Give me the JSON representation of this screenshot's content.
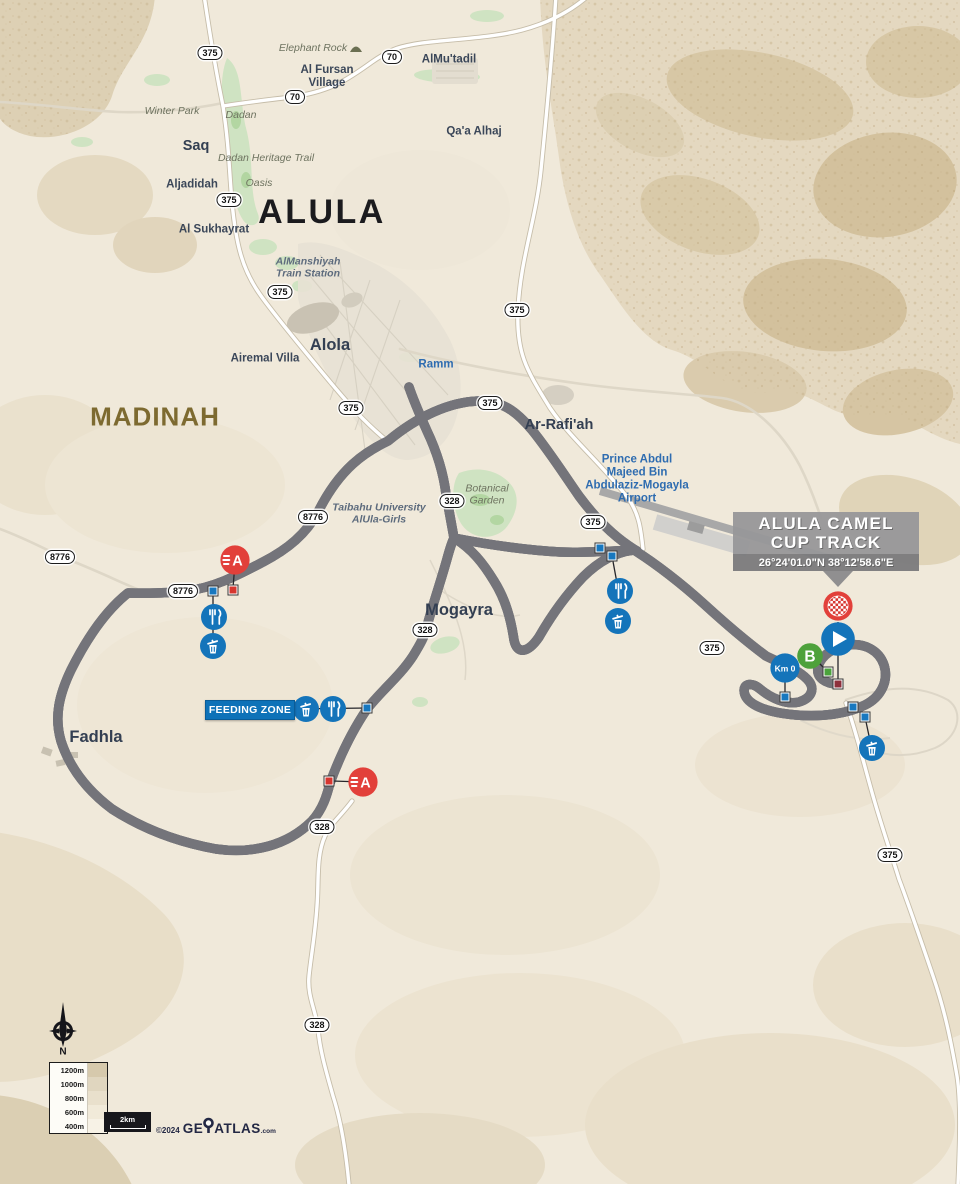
{
  "finish_panel": {
    "line1": "ALULA CAMEL",
    "line2": "CUP TRACK",
    "coordinates": "26°24'01.0\"N 38°12'58.6\"E"
  },
  "feeding_zone": {
    "label": "FEEDING ZONE"
  },
  "legend": {
    "elevations": [
      "1200m",
      "1000m",
      "800m",
      "600m",
      "400m"
    ],
    "swatches": [
      "#d6c9ac",
      "#e0d6bf",
      "#e9e0cc",
      "#f1ead9",
      "#f7f2e6"
    ],
    "scale_label": "2km",
    "copyright": "©2024",
    "brand_prefix": "GE",
    "brand_suffix": "ATLAS",
    "brand_tld": ".com",
    "compass": "N"
  },
  "markers": {
    "sprint_label": "A",
    "bonus_label": "B",
    "km_zero_label": "Km 0"
  },
  "colors": {
    "blue": "#1474ba",
    "red": "#e2403a",
    "green": "#4ea13b",
    "panel_gray": "#97979b"
  },
  "labels": [
    {
      "text": "Elephant Rock",
      "x": 313,
      "y": 49,
      "cls": "it"
    },
    {
      "text": "Al Fursan\nVillage",
      "x": 327,
      "y": 77,
      "cls": "town md"
    },
    {
      "text": "AlMu'tadil",
      "x": 449,
      "y": 60,
      "cls": "town md"
    },
    {
      "text": "Winter Park",
      "x": 172,
      "y": 112,
      "cls": "it"
    },
    {
      "text": "Dadan",
      "x": 241,
      "y": 116,
      "cls": "it"
    },
    {
      "text": "Saq",
      "x": 196,
      "y": 146,
      "cls": "town lg"
    },
    {
      "text": "Qa'a Alhaj",
      "x": 474,
      "y": 132,
      "cls": "town md"
    },
    {
      "text": "Dadan Heritage Trail",
      "x": 266,
      "y": 159,
      "cls": "it"
    },
    {
      "text": "Aljadidah",
      "x": 192,
      "y": 185,
      "cls": "town md"
    },
    {
      "text": "Oasis",
      "x": 259,
      "y": 184,
      "cls": "it"
    },
    {
      "text": "ALULA",
      "x": 322,
      "y": 212,
      "cls": "city"
    },
    {
      "text": "Al Sukhayrat",
      "x": 214,
      "y": 230,
      "cls": "town md"
    },
    {
      "text": "AlManshiyah\nTrain Station",
      "x": 308,
      "y": 268,
      "cls": "itb"
    },
    {
      "text": "Alola",
      "x": 330,
      "y": 345,
      "cls": "town xl"
    },
    {
      "text": "Airemal Villa",
      "x": 265,
      "y": 359,
      "cls": "town md"
    },
    {
      "text": "Ramm",
      "x": 436,
      "y": 365,
      "cls": "blue md"
    },
    {
      "text": "MADINAH",
      "x": 155,
      "y": 417,
      "cls": "region"
    },
    {
      "text": "Ar-Rafi'ah",
      "x": 559,
      "y": 425,
      "cls": "town lg"
    },
    {
      "text": "Prince Abdul\nMajeed Bin\nAbdulaziz-Mogayla\nAirport",
      "x": 637,
      "y": 479,
      "cls": "blue"
    },
    {
      "text": "Taibahu University\nAlUla-Girls",
      "x": 379,
      "y": 514,
      "cls": "itb"
    },
    {
      "text": "Botanical\nGarden",
      "x": 487,
      "y": 495,
      "cls": "it"
    },
    {
      "text": "Mogayra",
      "x": 459,
      "y": 610,
      "cls": "town xl"
    },
    {
      "text": "Fadhla",
      "x": 96,
      "y": 737,
      "cls": "town xl"
    }
  ],
  "shields": [
    {
      "num": "375",
      "x": 210,
      "y": 53
    },
    {
      "num": "70",
      "x": 295,
      "y": 97
    },
    {
      "num": "70",
      "x": 392,
      "y": 57
    },
    {
      "num": "375",
      "x": 229,
      "y": 200
    },
    {
      "num": "375",
      "x": 280,
      "y": 292
    },
    {
      "num": "375",
      "x": 517,
      "y": 310
    },
    {
      "num": "375",
      "x": 351,
      "y": 408
    },
    {
      "num": "375",
      "x": 490,
      "y": 403
    },
    {
      "num": "8776",
      "x": 60,
      "y": 557
    },
    {
      "num": "8776",
      "x": 313,
      "y": 517
    },
    {
      "num": "8776",
      "x": 183,
      "y": 591
    },
    {
      "num": "328",
      "x": 452,
      "y": 501
    },
    {
      "num": "375",
      "x": 593,
      "y": 522
    },
    {
      "num": "328",
      "x": 425,
      "y": 630
    },
    {
      "num": "375",
      "x": 712,
      "y": 648
    },
    {
      "num": "328",
      "x": 322,
      "y": 827
    },
    {
      "num": "375",
      "x": 890,
      "y": 855
    },
    {
      "num": "328",
      "x": 317,
      "y": 1025
    }
  ],
  "icons": [
    {
      "type": "rock",
      "x": 356,
      "y": 48
    },
    {
      "type": "sprint",
      "x": 235,
      "y": 560
    },
    {
      "type": "food",
      "x": 214,
      "y": 617
    },
    {
      "type": "trash",
      "x": 213,
      "y": 646
    },
    {
      "type": "trash",
      "x": 306,
      "y": 709
    },
    {
      "type": "food",
      "x": 333,
      "y": 709
    },
    {
      "type": "sprint",
      "x": 363,
      "y": 782
    },
    {
      "type": "food",
      "x": 620,
      "y": 591
    },
    {
      "type": "trash",
      "x": 618,
      "y": 621
    },
    {
      "type": "km0",
      "x": 785,
      "y": 668
    },
    {
      "type": "bonus",
      "x": 810,
      "y": 656
    },
    {
      "type": "start",
      "x": 838,
      "y": 639
    },
    {
      "type": "finish",
      "x": 838,
      "y": 606
    },
    {
      "type": "trash",
      "x": 872,
      "y": 748
    }
  ],
  "route_squares": [
    {
      "c": "blue",
      "x": 213,
      "y": 591
    },
    {
      "c": "red",
      "x": 233,
      "y": 590
    },
    {
      "c": "blue",
      "x": 367,
      "y": 708
    },
    {
      "c": "red",
      "x": 329,
      "y": 781
    },
    {
      "c": "blue",
      "x": 600,
      "y": 548
    },
    {
      "c": "blue",
      "x": 612,
      "y": 556
    },
    {
      "c": "blue",
      "x": 785,
      "y": 697
    },
    {
      "c": "green",
      "x": 828,
      "y": 672
    },
    {
      "c": "dark",
      "x": 838,
      "y": 684
    },
    {
      "c": "blue",
      "x": 853,
      "y": 707
    },
    {
      "c": "blue",
      "x": 865,
      "y": 717
    }
  ]
}
